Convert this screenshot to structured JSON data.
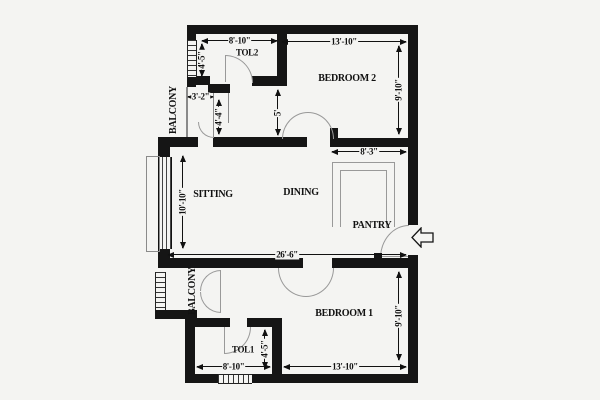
{
  "title": "apartment-floor-plan",
  "rooms": {
    "tol2": "TOL2",
    "bedroom2": "BEDROOM 2",
    "balcony_top": "BALCONY",
    "sitting": "SITTING",
    "dining": "DINING",
    "pantry": "PANTRY",
    "balcony_bottom": "BALCONY",
    "tol1": "TOL1",
    "bedroom1": "BEDROOM 1"
  },
  "dims": {
    "tol2_w": "8'-10\"",
    "bed2_w": "13'-10\"",
    "tol2_h": "4'-5\"",
    "bed2_h": "9'-10\"",
    "balc_w": "3'-2\"",
    "balc_h": "4'-4\"",
    "hall_h": "5'",
    "pantry_w": "8'-3\"",
    "sitting_h": "10'-10\"",
    "total_w": "26'-6\"",
    "bed1_h": "9'-10\"",
    "tol1_h": "4'-5\"",
    "tol1_w": "8'-10\"",
    "bed1_w": "13'-10\""
  },
  "icons": {
    "entry_arrow": "left-arrow"
  },
  "colors": {
    "wall": "#151515",
    "background": "#f4f4f2",
    "thin_line": "#8a8a8a",
    "door_arc": "#999999",
    "text": "#111111"
  }
}
